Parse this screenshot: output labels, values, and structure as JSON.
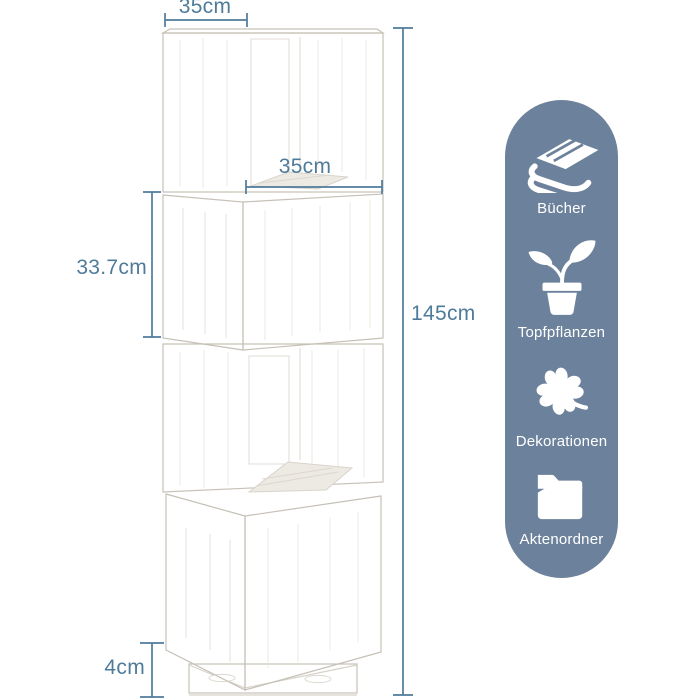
{
  "theme": {
    "background": "#ffffff",
    "dimension_color": "#4f7b9b",
    "capsule_bg": "#6c819b",
    "capsule_text": "#ffffff"
  },
  "diagram": {
    "subject": "rotating-cube-shelf",
    "dimensions": {
      "top_width": "35cm",
      "opening_width": "35cm",
      "cube_height": "33.7cm",
      "total_height": "145cm",
      "base_height": "4cm"
    }
  },
  "features_panel": {
    "items": [
      {
        "icon": "books-icon",
        "label": "Bücher"
      },
      {
        "icon": "potted-plant-icon",
        "label": "Topfpflanzen"
      },
      {
        "icon": "clover-icon",
        "label": "Dekorationen"
      },
      {
        "icon": "folder-icon",
        "label": "Aktenordner"
      }
    ]
  }
}
